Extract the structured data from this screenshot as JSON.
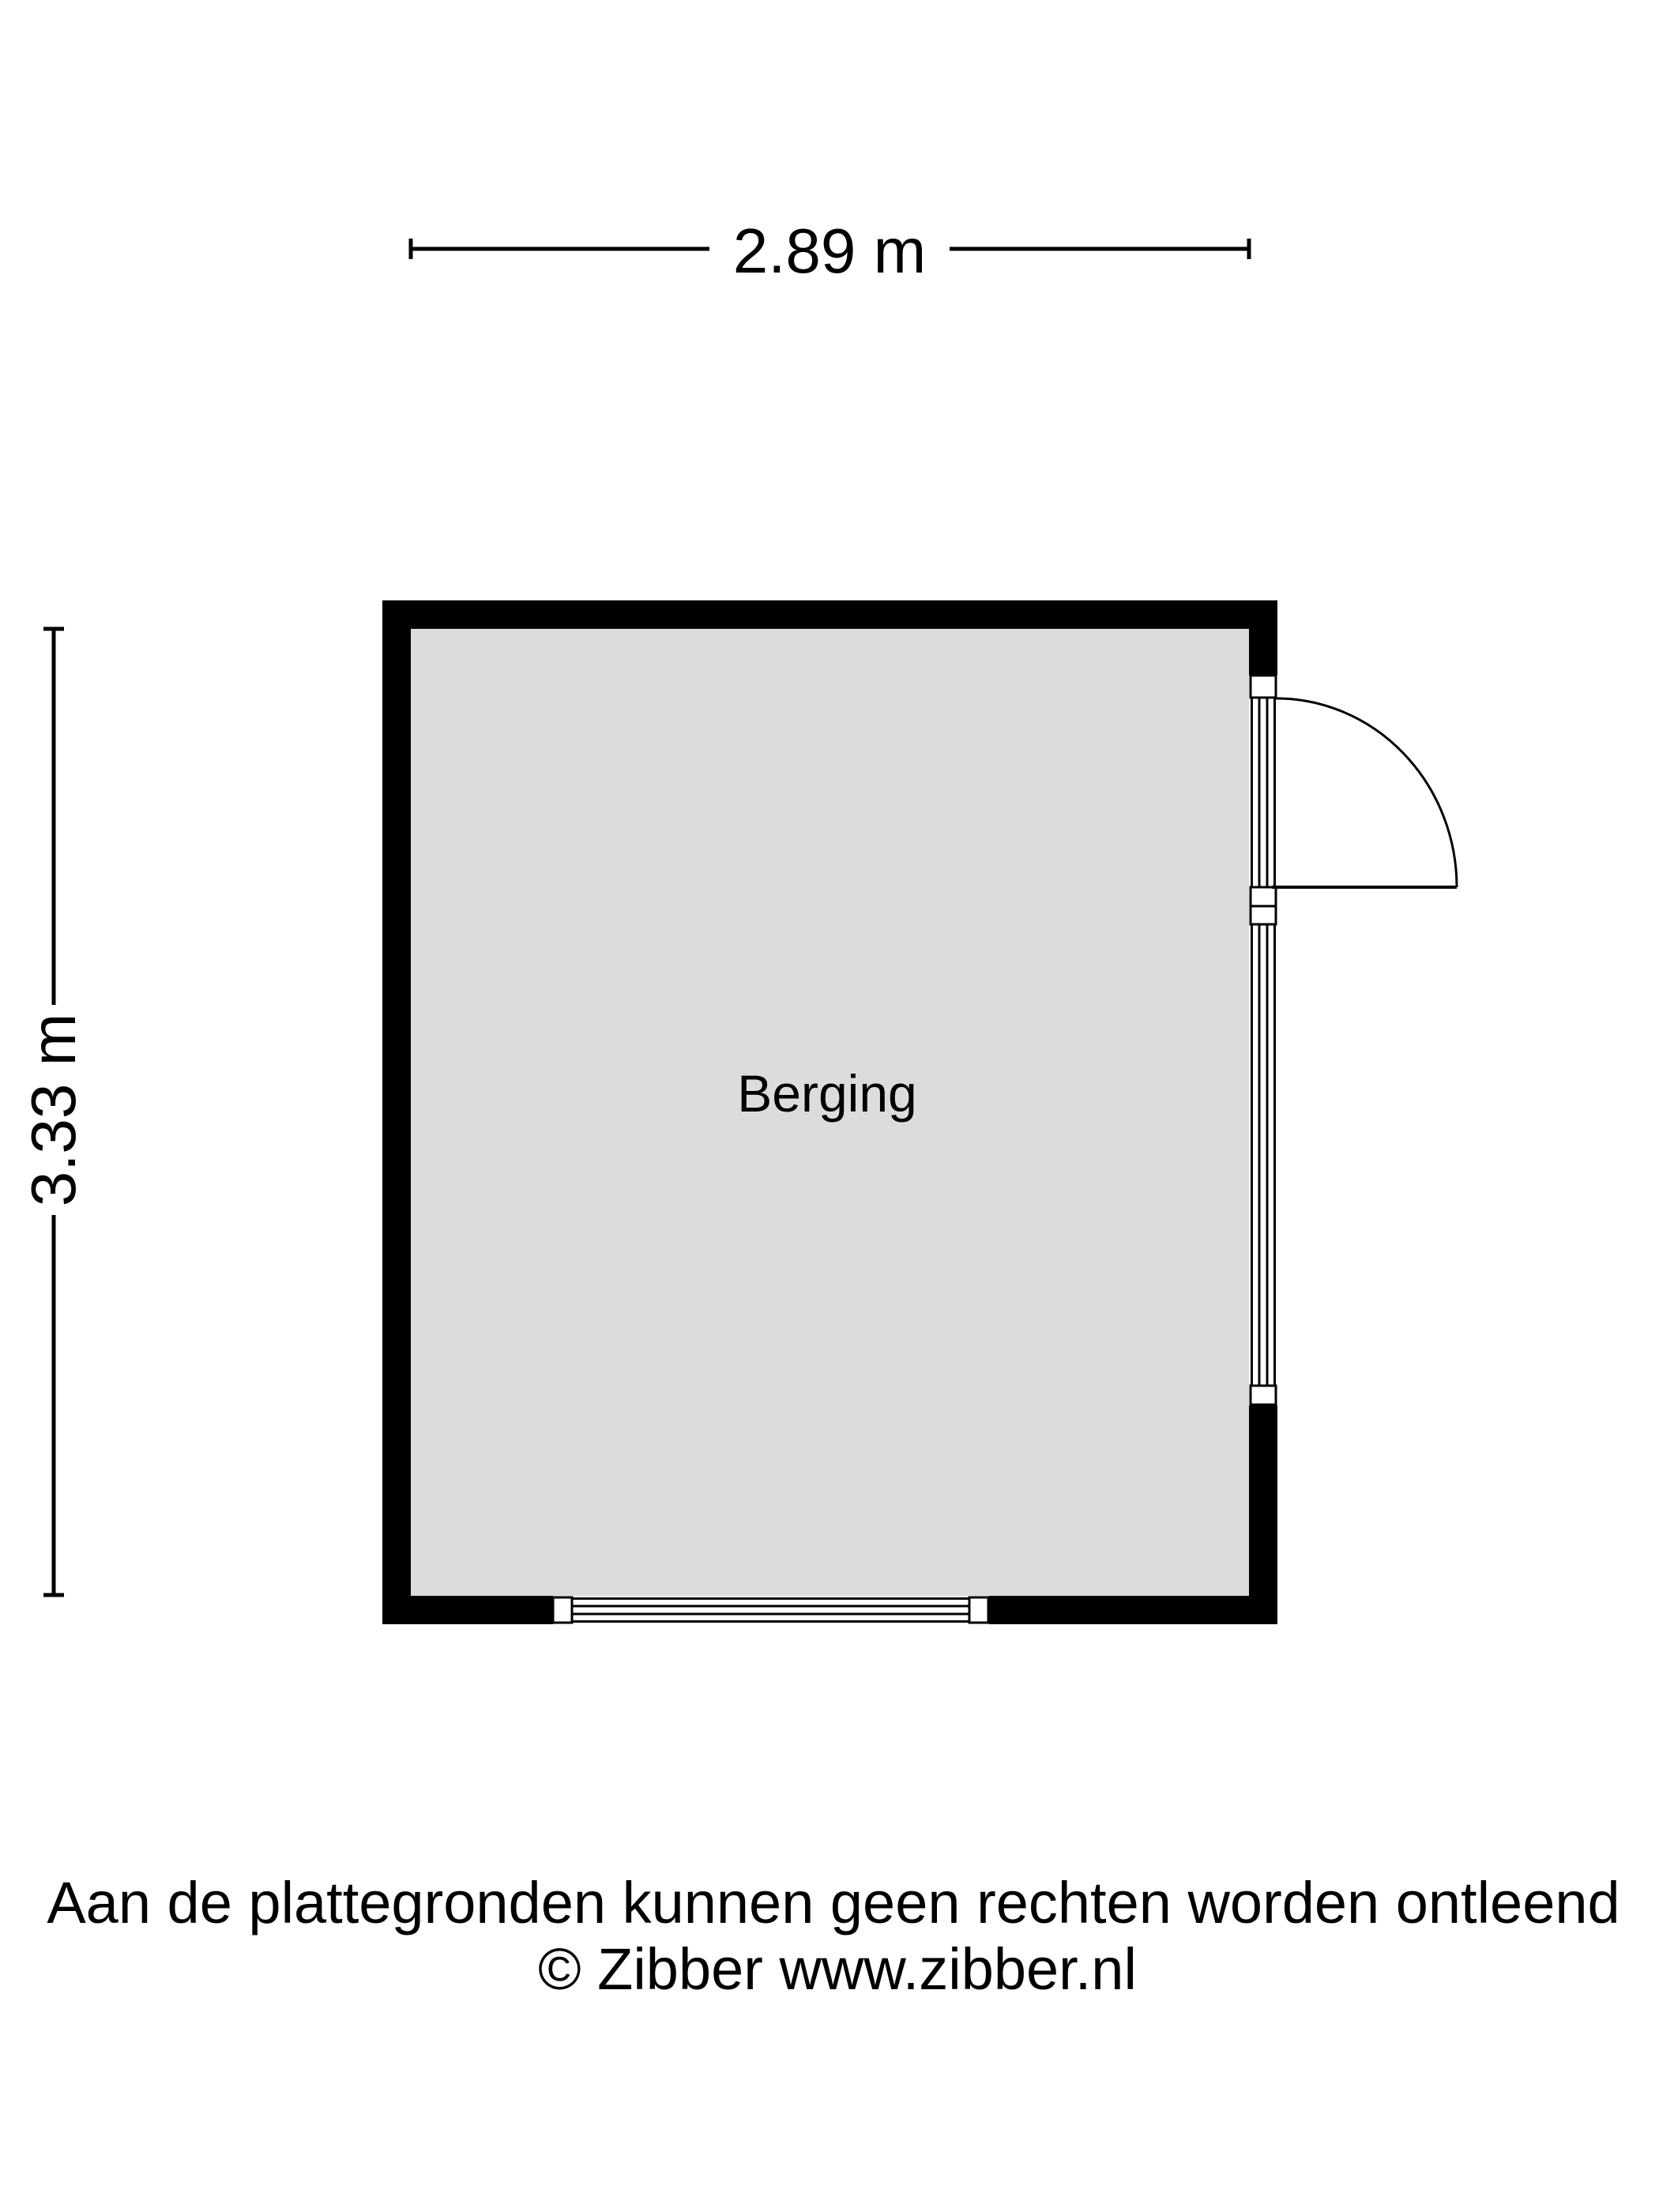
{
  "page": {
    "background": "#ffffff",
    "line_color": "#000000"
  },
  "dimensions": {
    "width_label": "2.89 m",
    "height_label": "3.33 m"
  },
  "room": {
    "name": "Berging",
    "floor_color": "#dcdcdc",
    "wall_color": "#000000"
  },
  "footer": {
    "disclaimer": "Aan de plattegronden kunnen geen rechten worden ontleend",
    "copyright": "© Zibber www.zibber.nl"
  }
}
